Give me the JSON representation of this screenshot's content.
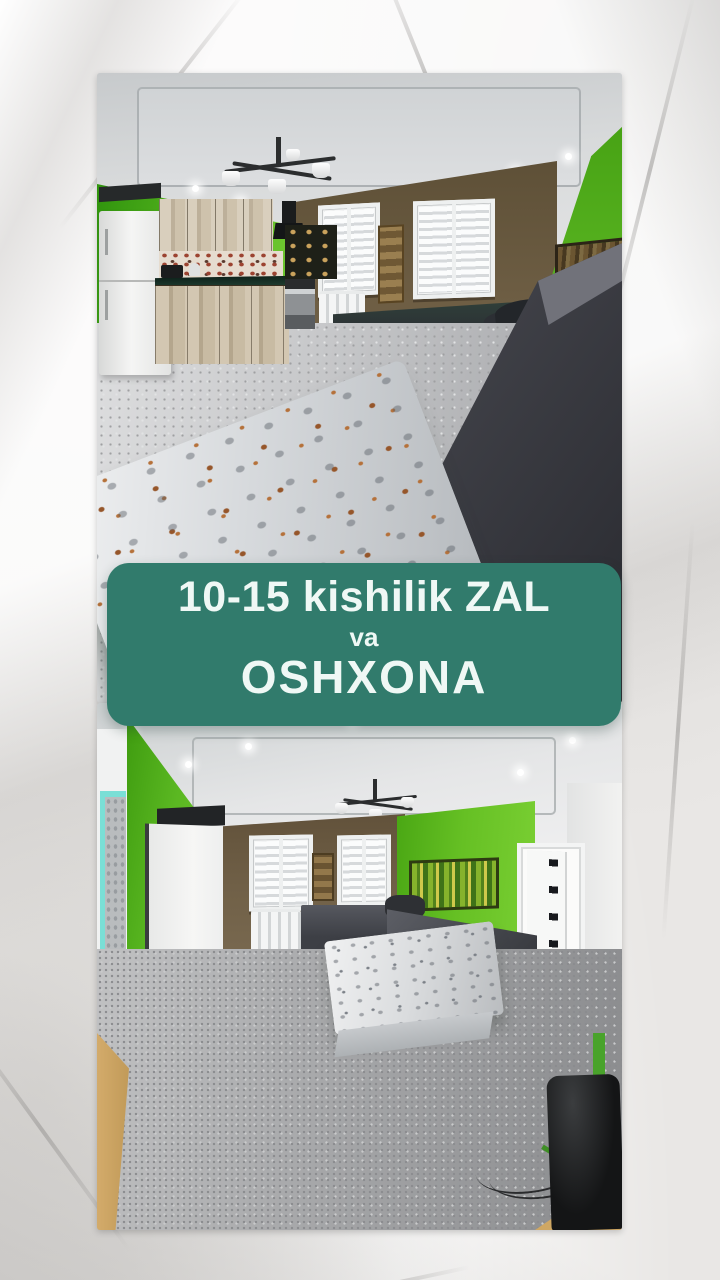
{
  "banner": {
    "line1": "10-15 kishilik ZAL",
    "line2": "va",
    "line3": "OSHXONA",
    "background_color": "#317b6c",
    "text_color": "#eff8f5"
  },
  "photos": {
    "top_alt": "Hall and kitchen: bright green walls, brown window wall with two blinds, white fridge, rustic wooden cabinets, dark corner sofas and a long low table with a grey floral cloth",
    "bottom_alt": "Hall: bright green and brown walls, two windows with blinds, white radiator, dark grey corner sofa, low table with light patterned cloth, grey carpet, white doors and a dark speaker"
  },
  "palette": {
    "paper_background": "#e9e7e5",
    "wall_green": "#5cb822",
    "wall_brown": "#6e5e44",
    "sofa_dark": "#3c3e45",
    "carpet_grey": "#a6a7a9",
    "ceiling_grey": "#d8dadb"
  }
}
